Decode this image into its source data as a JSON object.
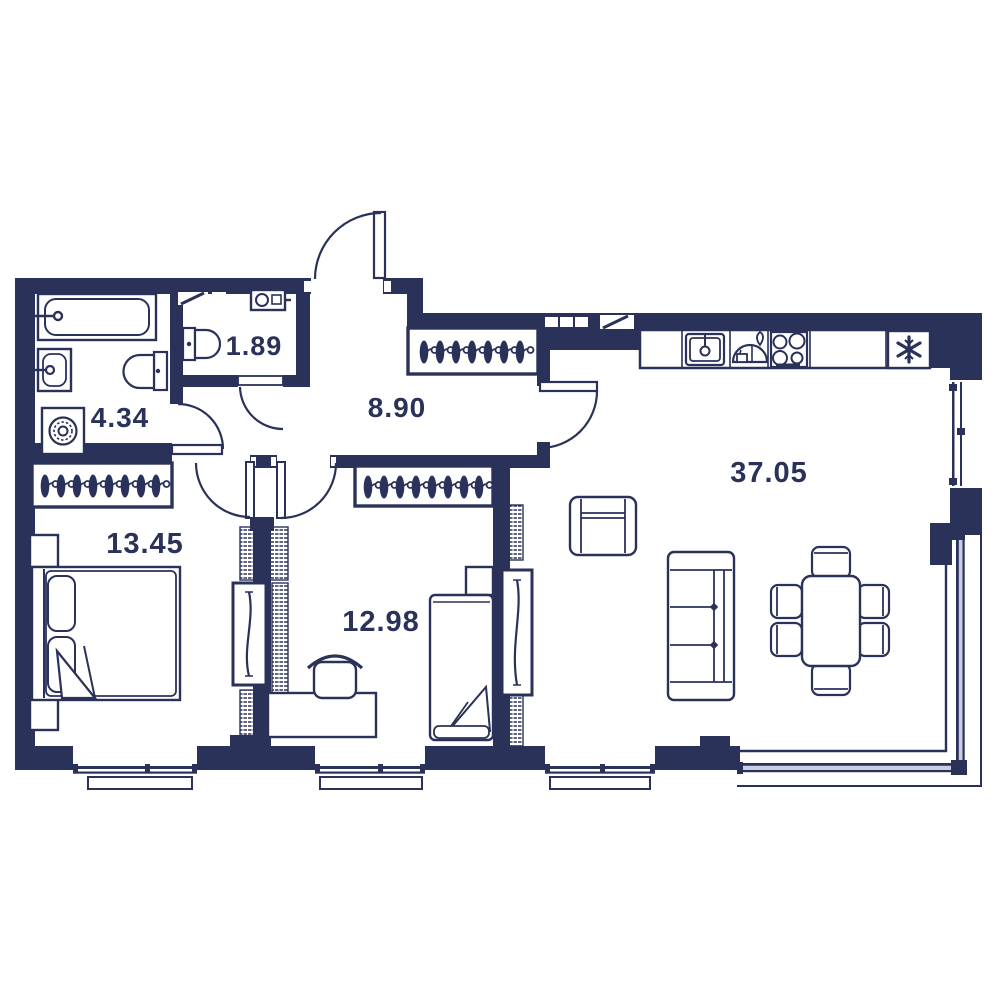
{
  "rooms": [
    {
      "name": "toilet",
      "area": "1.89"
    },
    {
      "name": "bathroom",
      "area": "4.34"
    },
    {
      "name": "hallway",
      "area": "8.90"
    },
    {
      "name": "bedroom",
      "area": "13.45"
    },
    {
      "name": "bedroom-2",
      "area": "12.98"
    },
    {
      "name": "living-room-kitchen",
      "area": "37.05"
    }
  ],
  "colors": {
    "wall": "#2a325a",
    "background": "#ffffff",
    "glazing_light": "#c9cde0"
  },
  "icons": {
    "fridge-snowflake-icon": "✻",
    "coat-hanger-icon": "hanger-shape",
    "bathtub-icon": "tub-shape",
    "washing-machine-icon": "drum-circle"
  }
}
